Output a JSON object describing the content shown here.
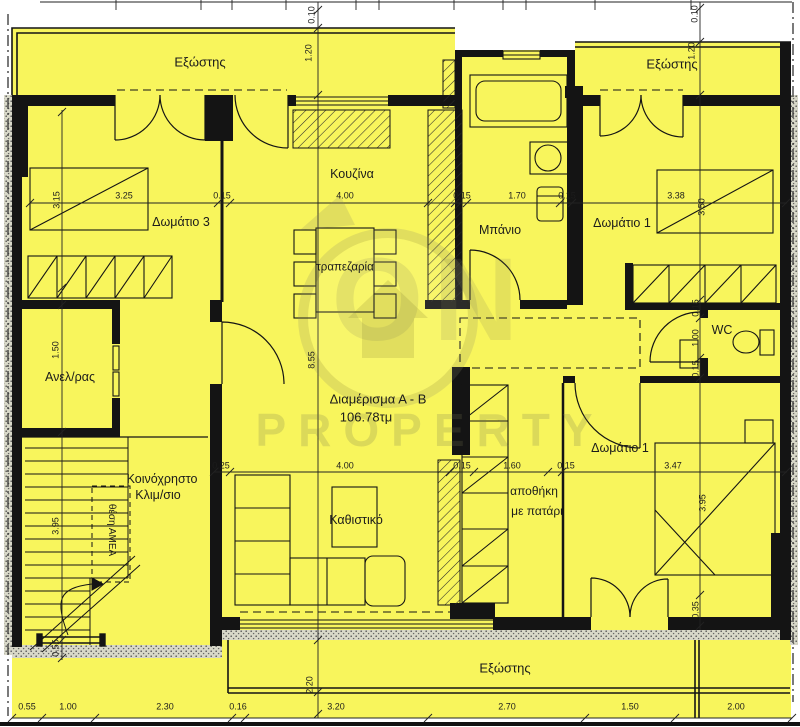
{
  "watermark": {
    "brand_top": "ON",
    "brand_bottom": "PROPERTY"
  },
  "apartment": {
    "name": "Διαμέρισμα Α - Β",
    "area": "106.78τμ"
  },
  "labels": [
    {
      "id": "balcony-top-left",
      "text": "Εξώστης",
      "x": 200,
      "y": 62,
      "size": 13
    },
    {
      "id": "balcony-top-right",
      "text": "Εξώστης",
      "x": 672,
      "y": 64,
      "size": 13
    },
    {
      "id": "balcony-bottom",
      "text": "Εξώστης",
      "x": 505,
      "y": 668,
      "size": 13
    },
    {
      "id": "bedroom-3",
      "text": "Δωμάτιο 3",
      "x": 181,
      "y": 222,
      "size": 12.5
    },
    {
      "id": "kitchen",
      "text": "Κουζίνα",
      "x": 352,
      "y": 174,
      "size": 12.5
    },
    {
      "id": "dining",
      "text": "τραπεζαρία",
      "x": 345,
      "y": 268,
      "size": 11.5
    },
    {
      "id": "bathroom",
      "text": "Μπάνιο",
      "x": 500,
      "y": 230,
      "size": 12.5
    },
    {
      "id": "bedroom-1-top",
      "text": "Δωμάτιο 1",
      "x": 622,
      "y": 223,
      "size": 12.5
    },
    {
      "id": "wc",
      "text": "WC",
      "x": 722,
      "y": 330,
      "size": 12.5
    },
    {
      "id": "elevator",
      "text": "Ανελ/ρας",
      "x": 70,
      "y": 377,
      "size": 12.5
    },
    {
      "id": "stairwell-line1",
      "text": "Κοινόχρηστο",
      "x": 162,
      "y": 479,
      "size": 12.5
    },
    {
      "id": "stairwell-line2",
      "text": "Κλιμ/σιο",
      "x": 158,
      "y": 495,
      "size": 12.5
    },
    {
      "id": "amea-spot",
      "text": "θέση ΑΜΕΑ",
      "x": 111,
      "y": 530,
      "size": 10,
      "rot": "90"
    },
    {
      "id": "apartment-title",
      "text": "Διαμέρισμα Α - Β",
      "x": 378,
      "y": 399,
      "size": 13
    },
    {
      "id": "apartment-area",
      "text": "106.78τμ",
      "x": 366,
      "y": 417,
      "size": 13
    },
    {
      "id": "storage-line1",
      "text": "αποθήκη",
      "x": 534,
      "y": 491,
      "size": 12
    },
    {
      "id": "storage-line2",
      "text": "με πατάρι",
      "x": 537,
      "y": 511,
      "size": 12
    },
    {
      "id": "bedroom-1-bottom",
      "text": "Δωμάτιο 1",
      "x": 620,
      "y": 448,
      "size": 12.5
    },
    {
      "id": "living-room",
      "text": "Καθιστικό",
      "x": 356,
      "y": 520,
      "size": 12.5
    }
  ],
  "dimensions": [
    {
      "text": "3.25",
      "x": 124,
      "y": 196
    },
    {
      "text": "0.15",
      "x": 222,
      "y": 196
    },
    {
      "text": "4.00",
      "x": 345,
      "y": 196
    },
    {
      "text": "0.15",
      "x": 462,
      "y": 196
    },
    {
      "text": "1.70",
      "x": 517,
      "y": 196
    },
    {
      "text": "0.15",
      "x": 567,
      "y": 196
    },
    {
      "text": "3.38",
      "x": 676,
      "y": 196
    },
    {
      "text": "3.15",
      "x": 57,
      "y": 200,
      "v": true
    },
    {
      "text": "3.50",
      "x": 702,
      "y": 207,
      "v": true
    },
    {
      "text": "0.25",
      "x": 221,
      "y": 466
    },
    {
      "text": "4.00",
      "x": 345,
      "y": 466
    },
    {
      "text": "0.15",
      "x": 462,
      "y": 466
    },
    {
      "text": "1.60",
      "x": 512,
      "y": 466
    },
    {
      "text": "0.15",
      "x": 566,
      "y": 466
    },
    {
      "text": "3.47",
      "x": 673,
      "y": 466
    },
    {
      "text": "3.95",
      "x": 703,
      "y": 503,
      "v": true
    },
    {
      "text": "0.10",
      "x": 312,
      "y": 15,
      "v": true
    },
    {
      "text": "1.20",
      "x": 309,
      "y": 53,
      "v": true
    },
    {
      "text": "8.55",
      "x": 312,
      "y": 360,
      "v": true
    },
    {
      "text": "2.20",
      "x": 310,
      "y": 685,
      "v": true
    },
    {
      "text": "0.10",
      "x": 695,
      "y": 14,
      "v": true
    },
    {
      "text": "1.20",
      "x": 692,
      "y": 51,
      "v": true
    },
    {
      "text": "0.15",
      "x": 696,
      "y": 308,
      "v": true
    },
    {
      "text": "1.00",
      "x": 696,
      "y": 338,
      "v": true
    },
    {
      "text": "0.15",
      "x": 696,
      "y": 369,
      "v": true
    },
    {
      "text": "0.35",
      "x": 696,
      "y": 610,
      "v": true
    },
    {
      "text": "1.50",
      "x": 56,
      "y": 350,
      "v": true
    },
    {
      "text": "3.95",
      "x": 56,
      "y": 526,
      "v": true
    },
    {
      "text": "0.55",
      "x": 56,
      "y": 648,
      "v": true
    },
    {
      "text": "0.55",
      "x": 27,
      "y": 707
    },
    {
      "text": "1.00",
      "x": 68,
      "y": 707
    },
    {
      "text": "2.30",
      "x": 165,
      "y": 707
    },
    {
      "text": "0.16",
      "x": 238,
      "y": 707
    },
    {
      "text": "3.20",
      "x": 336,
      "y": 707
    },
    {
      "text": "2.70",
      "x": 507,
      "y": 707
    },
    {
      "text": "1.50",
      "x": 630,
      "y": 707
    },
    {
      "text": "2.00",
      "x": 736,
      "y": 707
    }
  ]
}
